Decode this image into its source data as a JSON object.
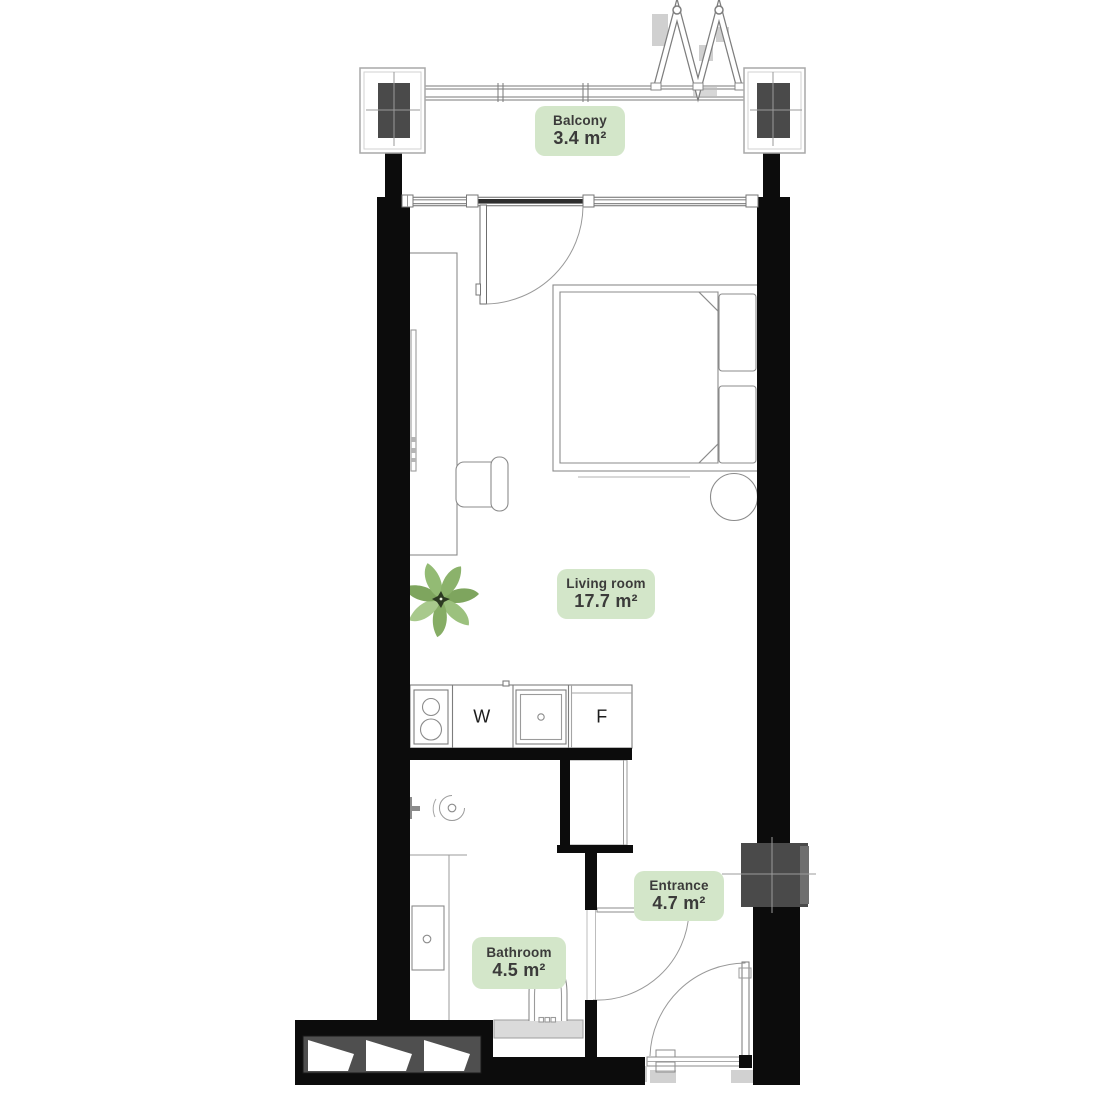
{
  "title": "Studio apartment floor plan",
  "rooms": [
    {
      "id": "balcony",
      "name": "Balcony",
      "area": "3.4 m²"
    },
    {
      "id": "living_room",
      "name": "Living room",
      "area": "17.7 m²"
    },
    {
      "id": "entrance",
      "name": "Entrance",
      "area": "4.7 m²"
    },
    {
      "id": "bathroom",
      "name": "Bathroom",
      "area": "4.5 m²"
    }
  ],
  "appliances": {
    "washer": "W",
    "fridge": "F"
  },
  "colors": {
    "wall": "#0c0c0c",
    "column": "#4a4a4a",
    "badge_bg": "#d3e6c9",
    "badge_text": "#3b3b3a",
    "outline": "#8b8b8b",
    "plant_green": "#8fb36b",
    "vanity": "#dadada",
    "shaft": "#4f4f4f"
  }
}
